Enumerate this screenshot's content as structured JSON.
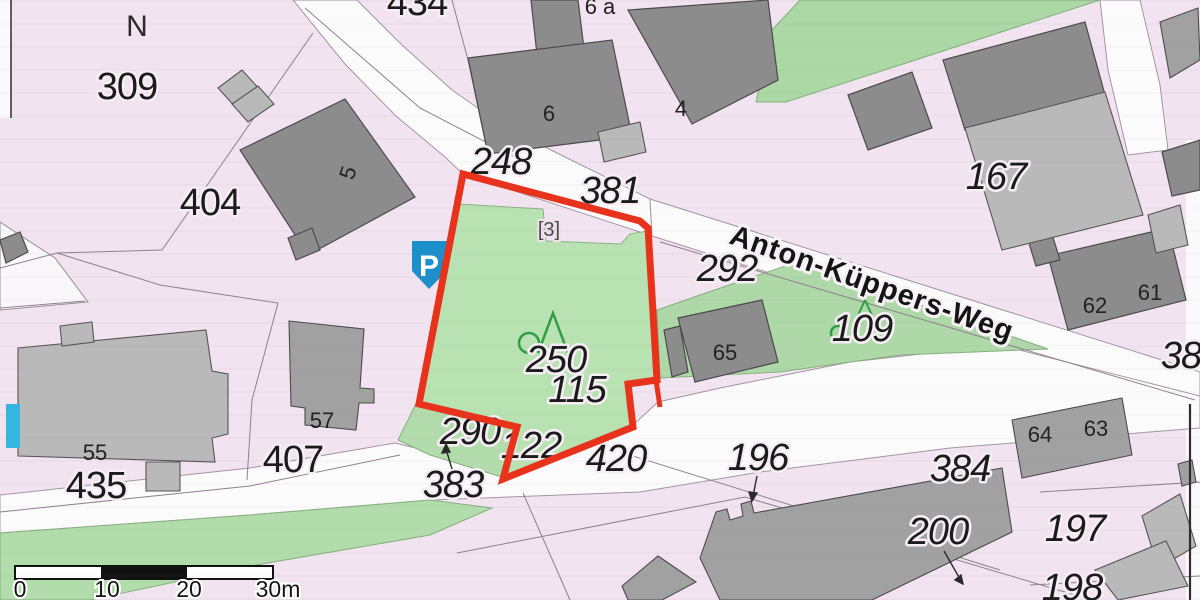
{
  "north_indicator": "N",
  "street": {
    "name": "Anton-Küppers-Weg"
  },
  "parking": {
    "label": "P"
  },
  "reference_label": "[3]",
  "scale_bar": {
    "ticks": [
      "0",
      "10",
      "20",
      "30m"
    ]
  },
  "labels": {
    "parcels_upright": [
      {
        "text": "309",
        "x": 127,
        "y": 99
      },
      {
        "text": "404",
        "x": 210,
        "y": 215
      },
      {
        "text": "434",
        "x": 417,
        "y": 15
      },
      {
        "text": "435",
        "x": 96,
        "y": 498
      },
      {
        "text": "407",
        "x": 293,
        "y": 472
      }
    ],
    "parcels_italic": [
      {
        "text": "248",
        "x": 501,
        "y": 174
      },
      {
        "text": "381",
        "x": 610,
        "y": 203
      },
      {
        "text": "292",
        "x": 727,
        "y": 281
      },
      {
        "text": "109",
        "x": 862,
        "y": 341
      },
      {
        "text": "167",
        "x": 996,
        "y": 189
      },
      {
        "text": "250",
        "x": 556,
        "y": 372
      },
      {
        "text": "115",
        "x": 577,
        "y": 402
      },
      {
        "text": "290",
        "x": 470,
        "y": 444
      },
      {
        "text": "122",
        "x": 531,
        "y": 458
      },
      {
        "text": "383",
        "x": 453,
        "y": 497
      },
      {
        "text": "420",
        "x": 616,
        "y": 471
      },
      {
        "text": "196",
        "x": 758,
        "y": 470
      },
      {
        "text": "384",
        "x": 960,
        "y": 481
      },
      {
        "text": "200",
        "x": 938,
        "y": 544
      },
      {
        "text": "197",
        "x": 1075,
        "y": 541
      },
      {
        "text": "198",
        "x": 1072,
        "y": 600
      },
      {
        "text": "38",
        "x": 1181,
        "y": 368
      }
    ],
    "buildings": [
      {
        "text": "5",
        "x": 355,
        "y": 175,
        "rot": -72
      },
      {
        "text": "6 a",
        "x": 600,
        "y": 14
      },
      {
        "text": "6",
        "x": 549,
        "y": 121
      },
      {
        "text": "4",
        "x": 681,
        "y": 116
      },
      {
        "text": "55",
        "x": 95,
        "y": 460
      },
      {
        "text": "57",
        "x": 322,
        "y": 428
      },
      {
        "text": "65",
        "x": 725,
        "y": 360
      },
      {
        "text": "62",
        "x": 1095,
        "y": 313
      },
      {
        "text": "61",
        "x": 1150,
        "y": 300
      },
      {
        "text": "64",
        "x": 1040,
        "y": 442
      },
      {
        "text": "63",
        "x": 1096,
        "y": 436
      }
    ]
  },
  "colors": {
    "map_pink": "#f1e3ef",
    "road_white": "#fcfbfc",
    "vegetation_green": "#b7e0b0",
    "building_dark": "#8d8c8d",
    "building_mid": "#a2a1a2",
    "building_light": "#bab9ba",
    "highlight_red": "#e8321b",
    "parking_blue": "#1d8fca",
    "marker_cyan": "#35b6df",
    "tree_green": "#2f9e44"
  }
}
